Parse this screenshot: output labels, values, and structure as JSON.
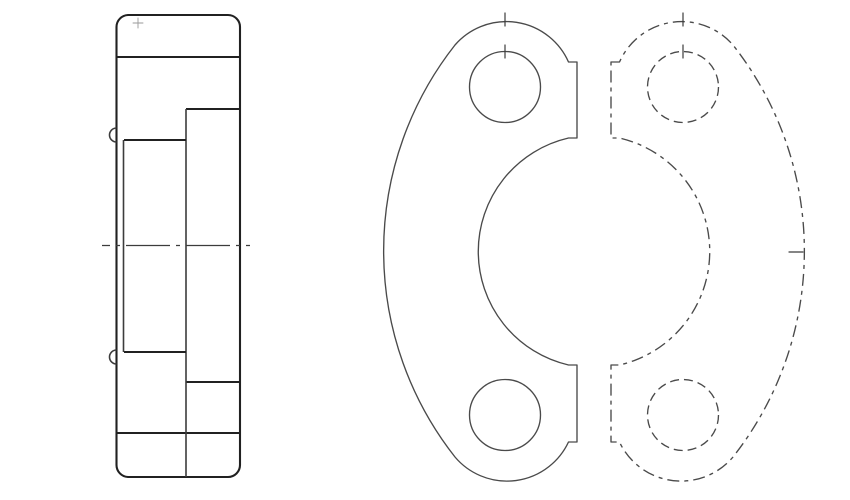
{
  "colors": {
    "background": "#ffffff",
    "line_strong": "#212121",
    "line_mid": "#3c3c3c",
    "line_medium": "#4a4a4a",
    "line_faint": "#9a9a9a"
  },
  "side_view": {
    "shapes": [
      {
        "type": "path",
        "name": "body-outline",
        "cls": "s-strong",
        "attrs": {
          "d": "M128,15 H228 A12,12 0 0 1 240,27 V465 A12,12 0 0 1 228,477 H128 A12,12 0 0 1 116.5,465 V27 A12,12 0 0 1 128,15 Z"
        }
      },
      {
        "type": "line",
        "name": "top-lobe-edge",
        "cls": "s-strong",
        "attrs": {
          "x1": 116.5,
          "y1": 57,
          "x2": 240,
          "y2": 57
        }
      },
      {
        "type": "line",
        "name": "bottom-lobe-edge",
        "cls": "s-strong",
        "attrs": {
          "x1": 116.5,
          "y1": 433,
          "x2": 240,
          "y2": 433
        }
      },
      {
        "type": "line",
        "name": "flange-step-top",
        "cls": "s-strong",
        "attrs": {
          "x1": 186,
          "y1": 109,
          "x2": 240,
          "y2": 109
        }
      },
      {
        "type": "line",
        "name": "flange-step-bottom",
        "cls": "s-strong",
        "attrs": {
          "x1": 186,
          "y1": 382,
          "x2": 240,
          "y2": 382
        }
      },
      {
        "type": "line",
        "name": "flange-face-vertical",
        "cls": "s-mid",
        "attrs": {
          "x1": 186,
          "y1": 109,
          "x2": 186,
          "y2": 477
        }
      },
      {
        "type": "line",
        "name": "bore-shoulder-top",
        "cls": "s-strong",
        "attrs": {
          "x1": 124,
          "y1": 140,
          "x2": 186,
          "y2": 140
        }
      },
      {
        "type": "line",
        "name": "bore-shoulder-bottom",
        "cls": "s-strong",
        "attrs": {
          "x1": 124,
          "y1": 352,
          "x2": 186,
          "y2": 352
        }
      },
      {
        "type": "line",
        "name": "bore-saddle-vertical",
        "cls": "s-mid",
        "attrs": {
          "x1": 123.5,
          "y1": 140,
          "x2": 123.5,
          "y2": 352
        }
      },
      {
        "type": "path",
        "name": "relief-notch-top",
        "cls": "s-mid",
        "attrs": {
          "d": "M116.5,128 A7,7 0 0 0 116.5,142"
        }
      },
      {
        "type": "path",
        "name": "relief-notch-bottom",
        "cls": "s-mid",
        "attrs": {
          "d": "M116.5,350 A7,7 0 0 0 116.5,364"
        }
      },
      {
        "type": "line",
        "name": "horizontal-centerline",
        "cls": "s-center",
        "attrs": {
          "x1": 102,
          "y1": 245.5,
          "x2": 250,
          "y2": 245.5
        }
      },
      {
        "type": "path",
        "name": "corner-center-mark",
        "cls": "s-faint",
        "attrs": {
          "d": "M133,23 H143 M138,18 V28"
        }
      }
    ]
  },
  "front_view": {
    "shapes": [
      {
        "type": "path",
        "name": "left-half-outline",
        "cls": "s-thin",
        "attrs": {
          "d": "M577,62 L568.5,62 A68,68 0 0 0 455,45 A333,333 0 0 0 455,457 A68,68 0 0 0 568.5,442 L577,442 L577,365 L568.5,365 A116.5,116.5 0 0 1 568.5,138 L577,138 Z"
        }
      },
      {
        "type": "circle",
        "name": "bolt-hole-top-left",
        "cls": "s-thin",
        "attrs": {
          "cx": 505,
          "cy": 87,
          "r": 35.5
        }
      },
      {
        "type": "circle",
        "name": "bolt-hole-bottom-left",
        "cls": "s-thin",
        "attrs": {
          "cx": 505,
          "cy": 415,
          "r": 35.5
        }
      },
      {
        "type": "path",
        "name": "right-half-outline-dashed",
        "cls": "s-dashed",
        "attrs": {
          "d": "M611,62 L619.5,62 A68,68 0 0 1 733,45 A333,333 0 0 1 733,457 A68,68 0 0 1 619.5,442 L611,442 L611,365 L619.5,365 A116.5,116.5 0 0 0 619.5,138 L611,138 Z"
        }
      },
      {
        "type": "circle",
        "name": "bolt-hole-top-right-dashed",
        "cls": "s-dashed-c",
        "attrs": {
          "cx": 683,
          "cy": 87,
          "r": 35.5
        }
      },
      {
        "type": "circle",
        "name": "bolt-hole-bottom-right-dashed",
        "cls": "s-dashed-c",
        "attrs": {
          "cx": 683,
          "cy": 415,
          "r": 35.5
        }
      },
      {
        "type": "line",
        "name": "center-tick-top-left-outer",
        "cls": "s-tick",
        "attrs": {
          "x1": 505,
          "y1": 13,
          "x2": 505,
          "y2": 26
        }
      },
      {
        "type": "line",
        "name": "center-tick-top-left-hole",
        "cls": "s-tick",
        "attrs": {
          "x1": 505,
          "y1": 45,
          "x2": 505,
          "y2": 58
        }
      },
      {
        "type": "line",
        "name": "center-tick-top-right-outer",
        "cls": "s-tick",
        "attrs": {
          "x1": 683,
          "y1": 13,
          "x2": 683,
          "y2": 26
        }
      },
      {
        "type": "line",
        "name": "center-tick-top-right-hole",
        "cls": "s-tick",
        "attrs": {
          "x1": 683,
          "y1": 45,
          "x2": 683,
          "y2": 58
        }
      },
      {
        "type": "line",
        "name": "center-tick-right-extremity",
        "cls": "s-tick",
        "attrs": {
          "x1": 789,
          "y1": 252,
          "x2": 803,
          "y2": 252
        }
      }
    ]
  }
}
